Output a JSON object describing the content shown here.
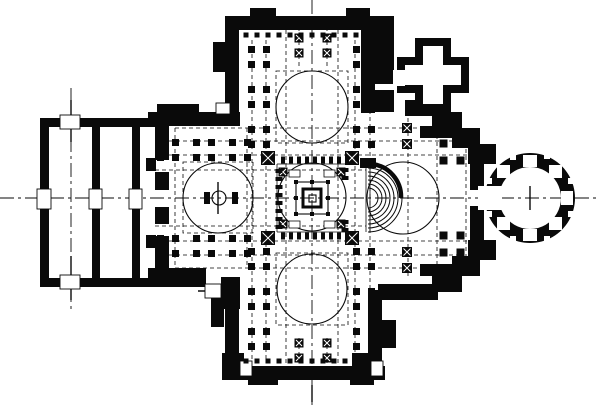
{
  "canvas": {
    "width": 600,
    "height": 405,
    "colors": {
      "ink": "#0a0a0a",
      "paper": "#ffffff"
    }
  },
  "figure": {
    "type": "architectural-floor-plan",
    "subject": "cruciform domed church plan: western narthex of two halls, four domed cross arms, central ciborium, eastern synthronon and apse rotunda, northeast cross-shaped chapel"
  },
  "layers": [
    {
      "name": "axis-centerlines",
      "type": "lines",
      "style": {
        "stroke": "ink",
        "sw": 0.9,
        "dash": "14 4 3 4"
      },
      "items": [
        [
          0,
          198,
          600,
          198
        ],
        [
          312,
          0,
          312,
          405
        ],
        [
          71,
          88,
          71,
          312
        ]
      ]
    },
    {
      "name": "axis-solid-ticks",
      "type": "lines",
      "style": {
        "stroke": "ink",
        "sw": 1.4
      },
      "items": [
        [
          71,
          100,
          71,
          142
        ],
        [
          71,
          256,
          71,
          300
        ],
        [
          198,
          291,
          230,
          291
        ],
        [
          218,
          182,
          218,
          214
        ],
        [
          530,
          186,
          530,
          210
        ],
        [
          312,
          385,
          312,
          402
        ]
      ]
    },
    {
      "name": "dashed-grid",
      "type": "lines",
      "style": {
        "stroke": "ink",
        "sw": 0.8,
        "dash": "4 3"
      },
      "items": [
        [
          162,
          141,
          460,
          141
        ],
        [
          162,
          155,
          476,
          155
        ],
        [
          155,
          170,
          366,
          170
        ],
        [
          155,
          226,
          366,
          226
        ],
        [
          162,
          241,
          476,
          241
        ],
        [
          162,
          255,
          460,
          255
        ],
        [
          175,
          128,
          458,
          128
        ],
        [
          175,
          268,
          452,
          268
        ],
        [
          252,
          40,
          252,
          362
        ],
        [
          266,
          40,
          266,
          362
        ],
        [
          286,
          30,
          286,
          376
        ],
        [
          338,
          30,
          338,
          376
        ],
        [
          355,
          40,
          355,
          362
        ],
        [
          370,
          40,
          370,
          362
        ],
        [
          299,
          20,
          299,
          66
        ],
        [
          327,
          20,
          327,
          66
        ],
        [
          299,
          338,
          299,
          380
        ],
        [
          327,
          338,
          327,
          380
        ],
        [
          175,
          128,
          175,
          268
        ],
        [
          247,
          128,
          247,
          268
        ],
        [
          437,
          128,
          437,
          268
        ],
        [
          466,
          128,
          466,
          268
        ],
        [
          408,
          118,
          408,
          278
        ]
      ]
    },
    {
      "name": "dashed-bay-outlines",
      "type": "outlines",
      "style": {
        "stroke": "ink",
        "sw": 0.8,
        "dash": "4 3"
      },
      "items": [
        [
          276,
          71,
          72,
          72
        ],
        [
          183,
          162,
          70,
          71
        ],
        [
          276,
          253,
          72,
          72
        ]
      ]
    },
    {
      "name": "dome-circles",
      "type": "circles",
      "style": {
        "stroke": "ink",
        "sw": 1.1,
        "fill": "none"
      },
      "items": [
        [
          312,
          107,
          36
        ],
        [
          218,
          198,
          35
        ],
        [
          312,
          289,
          35
        ],
        [
          312,
          197,
          34
        ],
        [
          403,
          198,
          36
        ]
      ]
    },
    {
      "name": "walls",
      "type": "rects",
      "style": {
        "fill": "ink"
      },
      "items": [
        [
          40,
          118,
          9,
          73
        ],
        [
          40,
          208,
          9,
          79
        ],
        [
          40,
          118,
          22,
          9
        ],
        [
          80,
          118,
          78,
          9
        ],
        [
          40,
          278,
          22,
          9
        ],
        [
          80,
          278,
          80,
          9
        ],
        [
          92,
          127,
          8,
          64
        ],
        [
          92,
          208,
          8,
          70
        ],
        [
          132,
          127,
          8,
          64
        ],
        [
          132,
          208,
          8,
          70
        ],
        [
          155,
          113,
          14,
          47
        ],
        [
          155,
          172,
          14,
          18
        ],
        [
          155,
          207,
          14,
          17
        ],
        [
          155,
          236,
          14,
          51
        ],
        [
          146,
          158,
          10,
          13
        ],
        [
          146,
          235,
          10,
          13
        ],
        [
          148,
          112,
          92,
          14
        ],
        [
          157,
          104,
          42,
          10
        ],
        [
          148,
          268,
          58,
          19
        ],
        [
          221,
          277,
          19,
          32
        ],
        [
          225,
          16,
          150,
          14
        ],
        [
          250,
          8,
          26,
          9
        ],
        [
          346,
          8,
          24,
          9
        ],
        [
          225,
          16,
          14,
          97
        ],
        [
          213,
          42,
          13,
          30
        ],
        [
          361,
          16,
          14,
          97
        ],
        [
          372,
          16,
          22,
          68
        ],
        [
          372,
          90,
          22,
          22
        ],
        [
          225,
          290,
          14,
          80
        ],
        [
          211,
          297,
          13,
          30
        ],
        [
          368,
          290,
          14,
          80
        ],
        [
          382,
          320,
          14,
          28
        ],
        [
          227,
          366,
          158,
          14
        ],
        [
          248,
          376,
          30,
          9
        ],
        [
          350,
          376,
          24,
          9
        ],
        [
          222,
          353,
          22,
          27
        ],
        [
          352,
          353,
          30,
          27
        ],
        [
          405,
          100,
          34,
          16
        ],
        [
          432,
          112,
          30,
          20
        ],
        [
          452,
          128,
          28,
          20
        ],
        [
          468,
          144,
          28,
          20
        ],
        [
          468,
          240,
          28,
          20
        ],
        [
          452,
          256,
          28,
          20
        ],
        [
          432,
          272,
          30,
          20
        ],
        [
          398,
          284,
          40,
          16
        ],
        [
          378,
          284,
          24,
          16
        ],
        [
          420,
          126,
          34,
          12
        ],
        [
          420,
          264,
          34,
          12
        ],
        [
          470,
          152,
          14,
          38
        ],
        [
          470,
          206,
          14,
          38
        ],
        [
          397,
          57,
          72,
          36
        ],
        [
          415,
          38,
          36,
          74
        ],
        [
          204,
          192,
          6,
          12
        ],
        [
          232,
          192,
          6,
          12
        ],
        [
          360,
          158,
          16,
          10
        ]
      ]
    },
    {
      "name": "rotunda-ring",
      "type": "paths",
      "style": {
        "fill": "ink",
        "fillRule": "evenodd"
      },
      "items": [
        "M530 153 a45 45 0 1 0 0.02 0 Z M530 167 a31 31 0 1 0 0.02 0 Z"
      ]
    },
    {
      "name": "white-openings",
      "type": "rects",
      "style": {
        "fill": "paper"
      },
      "items": [
        [
          405,
          65,
          56,
          20
        ],
        [
          423,
          46,
          20,
          58
        ],
        [
          393,
          70,
          12,
          16
        ],
        [
          478,
          186,
          24,
          24
        ],
        [
          561,
          191,
          12,
          14
        ],
        [
          523,
          155,
          14,
          12
        ],
        [
          523,
          229,
          14,
          12
        ],
        [
          549,
          165,
          13,
          13
        ],
        [
          497,
          165,
          13,
          13
        ],
        [
          497,
          217,
          13,
          13
        ],
        [
          549,
          217,
          13,
          13
        ],
        [
          568,
          178,
          6,
          6
        ],
        [
          544,
          153,
          6,
          6
        ],
        [
          510,
          154,
          6,
          6
        ],
        [
          486,
          178,
          6,
          6
        ],
        [
          486,
          211,
          6,
          6
        ],
        [
          510,
          236,
          6,
          6
        ],
        [
          544,
          236,
          6,
          6
        ],
        [
          568,
          211,
          6,
          6
        ]
      ]
    },
    {
      "name": "door-openings",
      "type": "rects",
      "style": {
        "fill": "paper",
        "stroke": "ink",
        "sw": 0.9
      },
      "items": [
        [
          37,
          189,
          14,
          20
        ],
        [
          89,
          189,
          13,
          20
        ],
        [
          129,
          189,
          13,
          20
        ],
        [
          60,
          115,
          20,
          14
        ],
        [
          60,
          275,
          20,
          14
        ],
        [
          205,
          284,
          16,
          14
        ],
        [
          216,
          103,
          14,
          11
        ],
        [
          240,
          361,
          12,
          15
        ],
        [
          371,
          361,
          12,
          15
        ]
      ]
    },
    {
      "name": "pier-clusters",
      "type": "clusters",
      "style": {
        "fill": "ink"
      },
      "items": [
        [
          259,
          57,
          7,
          7.5
        ],
        [
          259,
          97,
          7,
          7.5
        ],
        [
          259,
          137,
          7,
          7.5
        ],
        [
          364,
          57,
          7,
          7.5
        ],
        [
          364,
          97,
          7,
          7.5
        ],
        [
          364,
          137,
          7,
          7.5
        ],
        [
          168,
          150,
          7,
          7.5
        ],
        [
          204,
          150,
          7,
          7.5
        ],
        [
          240,
          150,
          7,
          7.5
        ],
        [
          168,
          246,
          7,
          7.5
        ],
        [
          204,
          246,
          7,
          7.5
        ],
        [
          240,
          246,
          7,
          7.5
        ],
        [
          259,
          259,
          7,
          7.5
        ],
        [
          259,
          299,
          7,
          7.5
        ],
        [
          259,
          339,
          7,
          7.5
        ],
        [
          364,
          259,
          7,
          7.5
        ],
        [
          364,
          299,
          7,
          7.5
        ],
        [
          364,
          339,
          7,
          7.5
        ],
        [
          452,
          152,
          8,
          8.5
        ],
        [
          452,
          244,
          8,
          8.5
        ]
      ]
    },
    {
      "name": "crossing-piers",
      "type": "xpiers",
      "style": {
        "fill": "ink"
      },
      "items": [
        [
          268,
          158,
          14
        ],
        [
          352,
          158,
          14
        ],
        [
          268,
          238,
          14
        ],
        [
          352,
          238,
          14
        ],
        [
          283,
          172,
          9
        ],
        [
          341,
          172,
          9
        ],
        [
          283,
          224,
          9
        ],
        [
          341,
          224,
          9
        ],
        [
          299,
          38,
          9
        ],
        [
          327,
          38,
          9
        ],
        [
          299,
          53,
          9
        ],
        [
          327,
          53,
          9
        ],
        [
          299,
          343,
          9
        ],
        [
          327,
          343,
          9
        ],
        [
          299,
          358,
          9
        ],
        [
          327,
          358,
          9
        ],
        [
          407,
          128,
          10
        ],
        [
          407,
          144,
          10
        ],
        [
          407,
          252,
          10
        ],
        [
          407,
          268,
          10
        ]
      ]
    },
    {
      "name": "colonnade-mark-rows",
      "type": "markrows",
      "style": {
        "fill": "ink"
      },
      "items": [
        {
          "x": 283,
          "y": 160,
          "dx": 8,
          "dy": 0,
          "n": 9,
          "w": 4,
          "h": 7
        },
        {
          "x": 283,
          "y": 236,
          "dx": 8,
          "dy": 0,
          "n": 9,
          "w": 4,
          "h": 7
        },
        {
          "x": 279,
          "y": 171,
          "dx": 0,
          "dy": 8,
          "n": 8,
          "w": 7,
          "h": 4
        },
        {
          "x": 345,
          "y": 170,
          "dx": 0,
          "dy": 8,
          "n": 2,
          "w": 7,
          "h": 4
        },
        {
          "x": 345,
          "y": 222,
          "dx": 0,
          "dy": 8,
          "n": 2,
          "w": 7,
          "h": 4
        },
        {
          "x": 246,
          "y": 35,
          "dx": 11,
          "dy": 0,
          "n": 12,
          "w": 5,
          "h": 5
        },
        {
          "x": 246,
          "y": 361,
          "dx": 11,
          "dy": 0,
          "n": 12,
          "w": 5,
          "h": 5
        }
      ]
    },
    {
      "name": "templon-lines",
      "type": "lines",
      "style": {
        "stroke": "ink",
        "sw": 0.8
      },
      "items": [
        [
          277,
          164,
          347,
          164
        ],
        [
          277,
          232,
          347,
          232
        ],
        [
          277,
          164,
          277,
          232
        ],
        [
          366,
          164,
          366,
          232
        ],
        [
          370,
          164,
          370,
          232
        ]
      ]
    },
    {
      "name": "ciborium-outline",
      "type": "outlines",
      "style": {
        "stroke": "ink",
        "sw": 1.1
      },
      "items": [
        [
          296,
          182,
          32,
          32
        ],
        [
          309,
          195,
          7,
          7
        ]
      ]
    },
    {
      "name": "ciborium-inner",
      "type": "outlines",
      "style": {
        "stroke": "ink",
        "sw": 3
      },
      "items": [
        [
          303,
          189,
          18,
          18
        ]
      ]
    },
    {
      "name": "ciborium-marks",
      "type": "squares",
      "style": {
        "fill": "ink"
      },
      "items": [
        [
          296,
          182,
          4
        ],
        [
          312,
          182,
          4
        ],
        [
          328,
          182,
          4
        ],
        [
          296,
          198,
          4
        ],
        [
          328,
          198,
          4
        ],
        [
          296,
          214,
          4
        ],
        [
          312,
          214,
          4
        ],
        [
          328,
          214,
          4
        ]
      ]
    },
    {
      "name": "chancel-boxes",
      "type": "rects",
      "style": {
        "fill": "paper",
        "stroke": "ink",
        "sw": 0.8
      },
      "items": [
        [
          289,
          170,
          11,
          7
        ],
        [
          324,
          170,
          11,
          7
        ],
        [
          289,
          221,
          11,
          7
        ],
        [
          324,
          221,
          11,
          7
        ]
      ]
    },
    {
      "name": "synthronon-steps",
      "type": "paths",
      "style": {
        "stroke": "ink",
        "sw": 1,
        "fill": "none"
      },
      "items": [
        "M368 188 A10 10 0 0 1 368 208",
        "M368 184 A14 14 0 0 1 368 212",
        "M368 180 A18 18 0 0 1 368 216",
        "M368 176 A22 22 0 0 1 368 220",
        "M368 172 A26 26 0 0 1 368 224",
        "M368 168 A30 30 0 0 1 368 228",
        "M368 164 A34 34 0 0 1 368 232"
      ]
    },
    {
      "name": "synthronon-rim",
      "type": "paths",
      "style": {
        "stroke": "ink",
        "sw": 4.5,
        "fill": "none"
      },
      "items": [
        "M372 164 A33 33 0 0 1 401 198"
      ]
    },
    {
      "name": "ambo-font",
      "type": "circles",
      "style": {
        "stroke": "ink",
        "sw": 1.1,
        "fill": "none"
      },
      "items": [
        [
          219,
          198,
          7
        ]
      ]
    }
  ]
}
